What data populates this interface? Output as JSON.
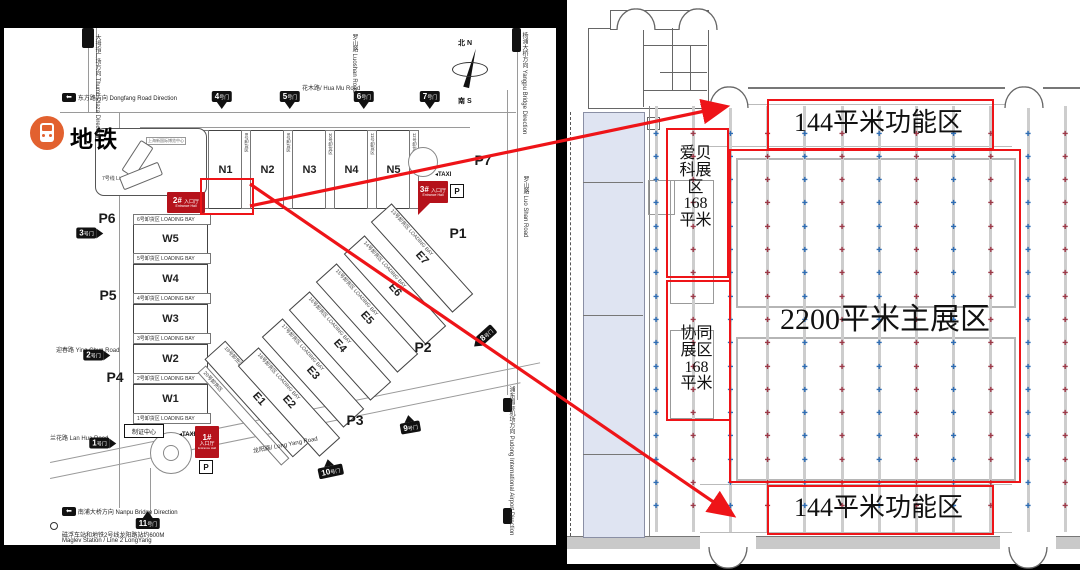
{
  "left_map": {
    "metro_label": "地铁",
    "line7_label": "7号线 Line 7",
    "callout_text": "上海新国际博览中心",
    "compass": {
      "north_cn": "北",
      "north_en": "N",
      "south_cn": "南",
      "south_en": "S"
    },
    "badges": [
      {
        "text": "东方路方向 Dongfang Road Direction",
        "x": 62,
        "y": 93
      },
      {
        "text": "南浦大桥方向 Nanpu Bridge Direction",
        "x": 62,
        "y": 507
      }
    ],
    "road_labels": [
      {
        "text": "大拇指广场方向 Thumb Plaza Direction",
        "x": 93,
        "y": 34,
        "vertical": true
      },
      {
        "text": "花木路/ Hua Mu Road",
        "x": 302,
        "y": 83
      },
      {
        "text": "罗山路 Luoshan Road",
        "x": 350,
        "y": 34,
        "vertical": true
      },
      {
        "text": "杨浦大桥方向 Yangpu Bridge Direction",
        "x": 520,
        "y": 32,
        "vertical": true
      },
      {
        "text": "罗山路 Luo Shan Road",
        "x": 521,
        "y": 176,
        "vertical": true
      },
      {
        "text": "浦东国际机场方向 Pudong International Airport Direction",
        "x": 507,
        "y": 386,
        "vertical": true
      },
      {
        "text": "迎春路 Ying Chun Road",
        "x": 56,
        "y": 345
      },
      {
        "text": "兰花路 Lan Hua Road",
        "x": 50,
        "y": 433
      },
      {
        "text": "龙阳路/ Long Yang Road",
        "x": 252,
        "y": 446,
        "rot": -11
      }
    ],
    "footnote_cn": "磁浮车站和地铁2号线龙阳路站约600M",
    "footnote_en": "Maglev Station / Line 2 LongYang",
    "n_halls": [
      {
        "label": "N1",
        "x": 208
      },
      {
        "label": "N2",
        "x": 250
      },
      {
        "label": "N3",
        "x": 292
      },
      {
        "label": "N4",
        "x": 334
      },
      {
        "label": "N5",
        "x": 376
      }
    ],
    "n_bays": [
      {
        "label": "7号卸货区",
        "x": 199
      },
      {
        "label": "8号卸货区",
        "x": 241
      },
      {
        "label": "9号卸货区",
        "x": 283
      },
      {
        "label": "10号卸货区",
        "x": 325
      },
      {
        "label": "11号卸货区",
        "x": 367
      },
      {
        "label": "12号卸货区",
        "x": 409
      }
    ],
    "w_halls": [
      {
        "label": "W5",
        "y": 224
      },
      {
        "label": "W4",
        "y": 264
      },
      {
        "label": "W3",
        "y": 304
      },
      {
        "label": "W2",
        "y": 344
      },
      {
        "label": "W1",
        "y": 384
      }
    ],
    "w_bays": [
      {
        "label": "6号卸货区",
        "y": 214
      },
      {
        "label": "5号卸货区",
        "y": 253
      },
      {
        "label": "4号卸货区",
        "y": 293
      },
      {
        "label": "3号卸货区",
        "y": 333
      },
      {
        "label": "2号卸货区",
        "y": 373
      },
      {
        "label": "1号卸货区",
        "y": 413
      }
    ],
    "loading_bay_en": "LOADING BAY",
    "e_halls": [
      {
        "label": "E1",
        "bay": "19号卸货区",
        "cx": 258,
        "cy": 398,
        "w": 130
      },
      {
        "label": "E2",
        "bay": "18号卸货区",
        "cx": 288,
        "cy": 401,
        "w": 120
      },
      {
        "label": "E3",
        "bay": "17号卸货区",
        "cx": 312,
        "cy": 372,
        "w": 120
      },
      {
        "label": "E4",
        "bay": "16号卸货区",
        "cx": 339,
        "cy": 345,
        "w": 120
      },
      {
        "label": "E5",
        "bay": "15号卸货区",
        "cx": 366,
        "cy": 317,
        "w": 120
      },
      {
        "label": "E6",
        "bay": "14号卸货区",
        "cx": 394,
        "cy": 289,
        "w": 120
      },
      {
        "label": "E7",
        "bay": "13号卸货区",
        "cx": 421,
        "cy": 257,
        "w": 120
      }
    ],
    "e_bay_extra": {
      "label": "20号卸货区",
      "cx": 241,
      "cy": 414
    },
    "gates": [
      {
        "label": "1号门",
        "x": 103,
        "y": 443,
        "dir": "right"
      },
      {
        "label": "2号门",
        "x": 97,
        "y": 355,
        "dir": "right"
      },
      {
        "label": "3号门",
        "x": 90,
        "y": 233,
        "dir": "right"
      },
      {
        "label": "4号门",
        "x": 222,
        "y": 100,
        "dir": "down"
      },
      {
        "label": "5号门",
        "x": 290,
        "y": 100,
        "dir": "down"
      },
      {
        "label": "6号门",
        "x": 364,
        "y": 100,
        "dir": "down"
      },
      {
        "label": "7号门",
        "x": 430,
        "y": 100,
        "dir": "down"
      },
      {
        "label": "8号门",
        "x": 484,
        "y": 337,
        "dir": "left",
        "rot": -42
      },
      {
        "label": "9号门",
        "x": 410,
        "y": 424,
        "dir": "up",
        "rot": -10
      },
      {
        "label": "10号门",
        "x": 330,
        "y": 468,
        "dir": "up",
        "rot": -12
      },
      {
        "label": "11号门",
        "x": 148,
        "y": 520,
        "dir": "up"
      }
    ],
    "parking": [
      {
        "label": "P1",
        "x": 458,
        "y": 233
      },
      {
        "label": "P2",
        "x": 423,
        "y": 347
      },
      {
        "label": "P3",
        "x": 355,
        "y": 420
      },
      {
        "label": "P4",
        "x": 115,
        "y": 377
      },
      {
        "label": "P5",
        "x": 108,
        "y": 295
      },
      {
        "label": "P6",
        "x": 107,
        "y": 218
      },
      {
        "label": "P7",
        "x": 483,
        "y": 160
      }
    ],
    "entrances": [
      {
        "num": "2#",
        "cn": "入口厅",
        "en": "Entrance Hall",
        "x": 167,
        "y": 192,
        "w": 38,
        "h": 21,
        "layout": "wide"
      },
      {
        "num": "1#",
        "cn": "入口厅",
        "en": "Entrance Hall",
        "x": 195,
        "y": 426,
        "w": 24,
        "h": 32,
        "layout": "tall"
      },
      {
        "num": "3#",
        "cn": "入口厅",
        "en": "Entrance Hall",
        "x": 418,
        "y": 181,
        "w": 30,
        "h": 22,
        "layout": "wide"
      }
    ],
    "taxi_label": "TAXI",
    "taxi_positions": [
      {
        "x": 179,
        "y": 431
      },
      {
        "x": 435,
        "y": 171
      }
    ],
    "p_label": "P",
    "p_positions": [
      {
        "x": 199,
        "y": 460
      },
      {
        "x": 450,
        "y": 184
      }
    ],
    "badge_center_label": "制证中心",
    "badge_center_pos": {
      "x": 124,
      "y": 424
    }
  },
  "highlight": {
    "x": 200,
    "y": 178,
    "w": 50,
    "h": 33
  },
  "arrows": [
    {
      "x1": 250,
      "y1": 206,
      "x2": 724,
      "y2": 107
    },
    {
      "x1": 250,
      "y1": 184,
      "x2": 731,
      "y2": 514
    }
  ],
  "right_plan": {
    "zone_top": {
      "text": "144平米功能区",
      "x": 767,
      "y": 99,
      "w": 223,
      "h": 47
    },
    "zone_bottom": {
      "text": "144平米功能区",
      "x": 767,
      "y": 485,
      "w": 223,
      "h": 46
    },
    "zone_main": {
      "text": "2200平米主展区",
      "x": 729,
      "y": 149,
      "w": 288,
      "h": 330
    },
    "zone_abk": {
      "text": "爱贝科展区 168平米",
      "lines": [
        "爱贝",
        "科展",
        "区",
        "168",
        "平米"
      ],
      "x": 666,
      "y": 128,
      "w": 59,
      "h": 146
    },
    "zone_xt": {
      "text": "协同展区 168平米",
      "lines": [
        "协同",
        "展区",
        "168",
        "平米"
      ],
      "x": 666,
      "y": 280,
      "w": 61,
      "h": 137
    },
    "grid": {
      "col_start": 656,
      "col_step": 37.2,
      "cols": 12,
      "row_start": 134,
      "row_step": 23.3,
      "rows": 17,
      "line_top": 106,
      "line_bottom": 532
    },
    "marker_glyph": "✚",
    "colors": {
      "blue": "#2e6db5",
      "red": "#9e3a49",
      "box_red": "#ee1418",
      "grid_line": "#cccccc",
      "wall": "#777777",
      "corridor_fill": "#dfe4f2"
    }
  }
}
